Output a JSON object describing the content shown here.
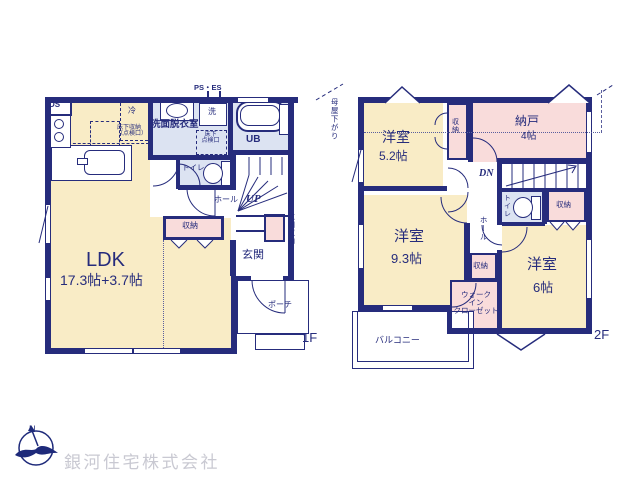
{
  "company": {
    "name": "銀河住宅株式会社",
    "north": "N"
  },
  "colors": {
    "wall": "#262c7c",
    "floor_beige": "#f9ecc6",
    "floor_blue": "#dce3f2",
    "floor_pink": "#f9dcdb",
    "logo_text": "#c9c9d2"
  },
  "floor1": {
    "floor_label": "1F",
    "ds": "DS",
    "refrigerator": "冷",
    "underfloor_storage_1": "床下収納",
    "underfloor_storage_2": "（点検口）",
    "ps_es": "PS・ES",
    "washroom": "洗面脱衣室",
    "washer": "洗",
    "underfloor_hatch_1": "床下",
    "underfloor_hatch_2": "点検口",
    "bath": "UB",
    "toilet": "トイレ",
    "hall": "ホール",
    "stairs_up": "UP",
    "storage": "収納",
    "entrance_storage": "玄関収納",
    "entrance": "玄関",
    "porch": "ポーチ",
    "ldk": "LDK",
    "ldk_size": "17.3帖+3.7帖"
  },
  "floor2": {
    "floor_label": "2F",
    "moya_sagari": "母屋下がり",
    "bedroom52": "洋室",
    "bedroom52_size": "5.2帖",
    "closet52": "収納",
    "storage_room": "納戸",
    "storage_room_size": "4帖",
    "stairs_down": "DN",
    "toilet": "トイレ",
    "closet_right": "収納",
    "bedroom93": "洋室",
    "bedroom93_size": "9.3帖",
    "hall": "ホール",
    "closet_hall": "収納",
    "wic_1": "ウォーク",
    "wic_2": "イン",
    "wic_3": "クローゼット",
    "bedroom6": "洋室",
    "bedroom6_size": "6帖",
    "balcony": "バルコニー"
  }
}
